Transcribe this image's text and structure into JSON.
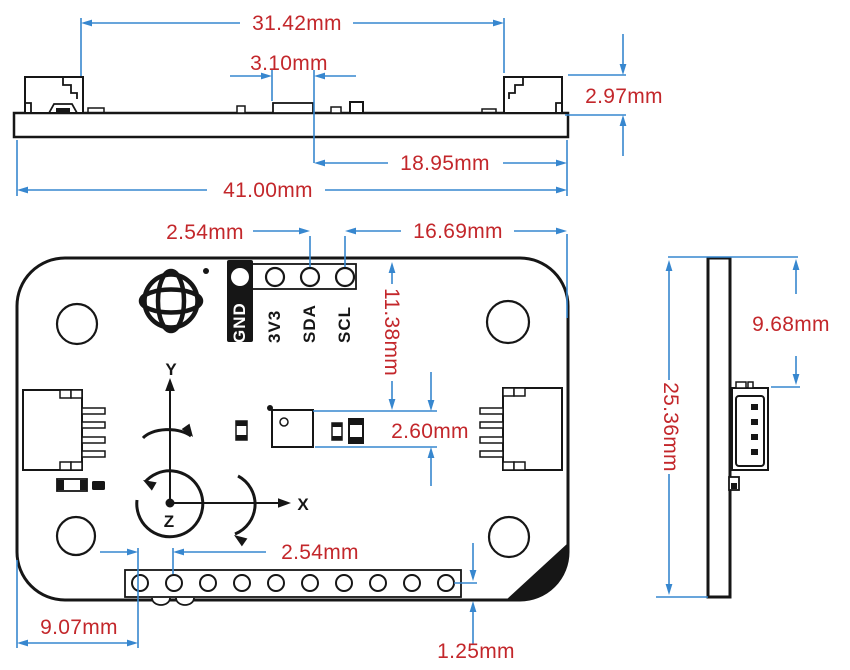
{
  "colors": {
    "dimension_red": "#c3272b",
    "dimension_blue": "#3787cf",
    "ink": "#161616"
  },
  "top_view": {
    "dim_connector_span": "31.42mm",
    "dim_chip_width": "3.10mm",
    "dim_connector_height": "2.97mm",
    "dim_chip_to_right_edge": "18.95mm",
    "dim_board_width": "41.00mm"
  },
  "front_view": {
    "pin_labels": [
      "GND",
      "3V3",
      "SDA",
      "SCL"
    ],
    "axis_labels": {
      "x": "X",
      "y": "Y",
      "z": "Z"
    },
    "dim_top_pin_pitch": "2.54mm",
    "dim_scl_to_right_edge": "16.69mm",
    "dim_top_edge_to_chip": "11.38mm",
    "dim_chip_height": "2.60mm",
    "dim_bottom_pin_pitch": "2.54mm",
    "dim_left_edge_to_pin1": "9.07mm",
    "dim_pin_row_to_bottom_edge": "1.25mm"
  },
  "side_view": {
    "dim_top_to_connector": "9.68mm",
    "dim_board_height": "25.36mm"
  }
}
